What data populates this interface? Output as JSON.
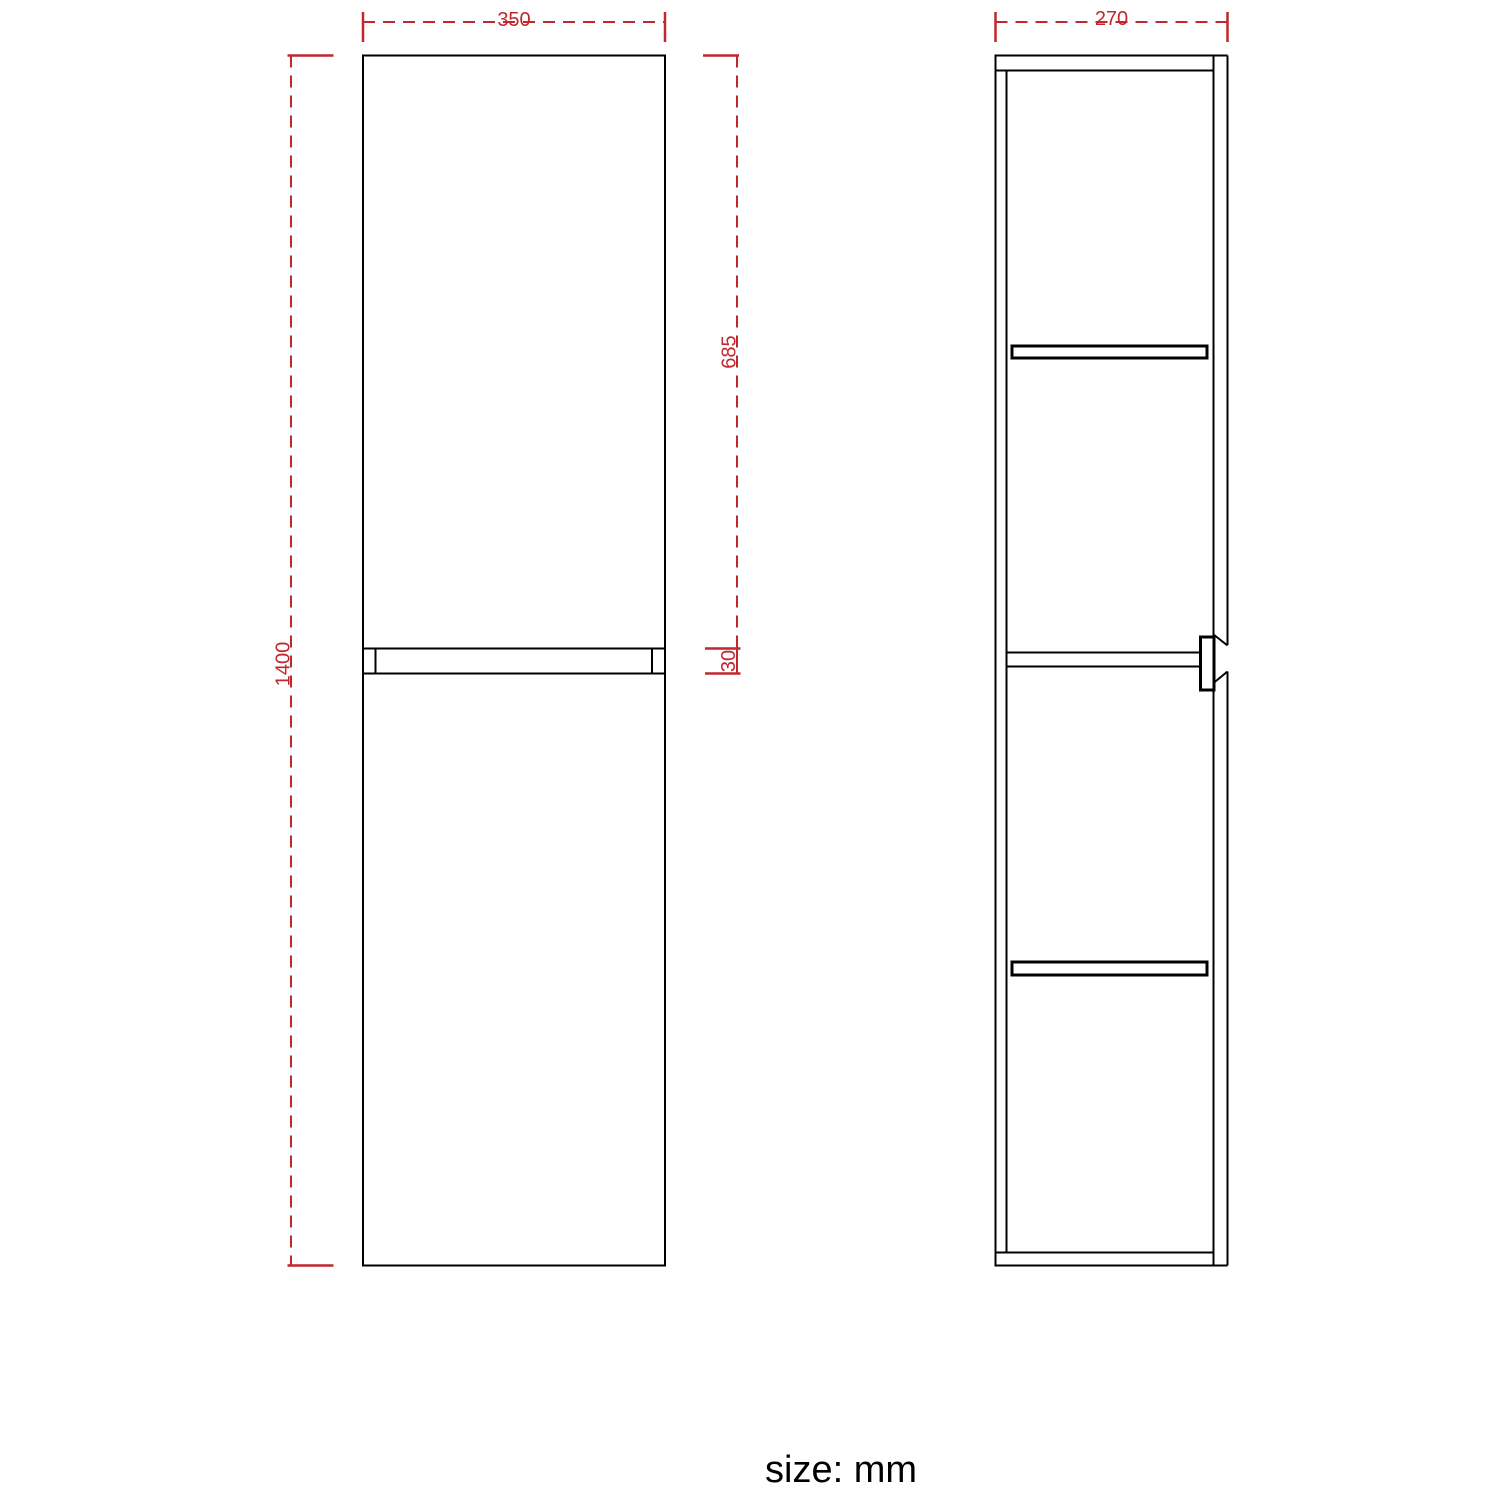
{
  "caption": "size: mm",
  "colors": {
    "line": "#000000",
    "dimension": "#c1272d",
    "background": "#ffffff"
  },
  "front_view": {
    "dimensions": {
      "width": "350",
      "height": "1400",
      "upper_door_height": "685",
      "door_gap": "30"
    }
  },
  "side_view": {
    "dimensions": {
      "depth": "270"
    }
  }
}
